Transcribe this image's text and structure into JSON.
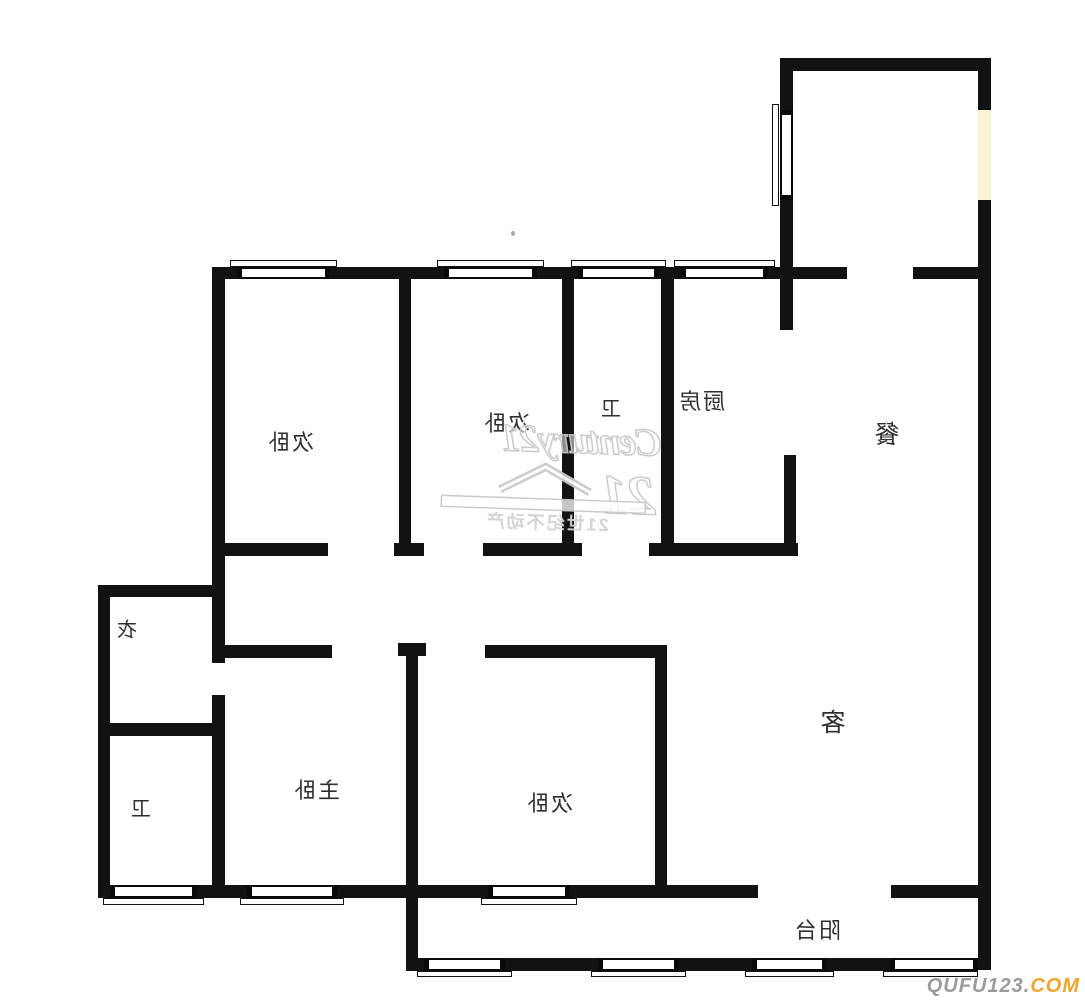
{
  "colors": {
    "wall": "#121212",
    "background": "#ffffff",
    "label": "#2f2f2f",
    "cream_window": "#fbf3d3",
    "watermark_stroke": "#c9c9c9",
    "watermark_fill": "rgba(255,255,255,0.55)",
    "watermark_text": "#d2d2d2",
    "credit_gray": "#9b9b9b",
    "credit_orange": "#f2a52f"
  },
  "rooms": {
    "bedroom_top_left": {
      "label": "次卧"
    },
    "bedroom_top_mid": {
      "label": "次卧"
    },
    "bath_top": {
      "label": "卫"
    },
    "kitchen": {
      "label": "厨房"
    },
    "dining": {
      "label": "餐"
    },
    "closet": {
      "label": "衣"
    },
    "bath_bottom": {
      "label": "卫"
    },
    "master_bedroom": {
      "label": "主卧"
    },
    "bedroom_bottom": {
      "label": "次卧"
    },
    "living": {
      "label": "客"
    },
    "balcony": {
      "label": "阳台"
    }
  },
  "watermark": {
    "brand": "Century21",
    "logo_number": "21",
    "caption": "21世纪不动产"
  },
  "site_credit": {
    "name": "QUFU123",
    "dot": ".",
    "suffix": "COM"
  }
}
